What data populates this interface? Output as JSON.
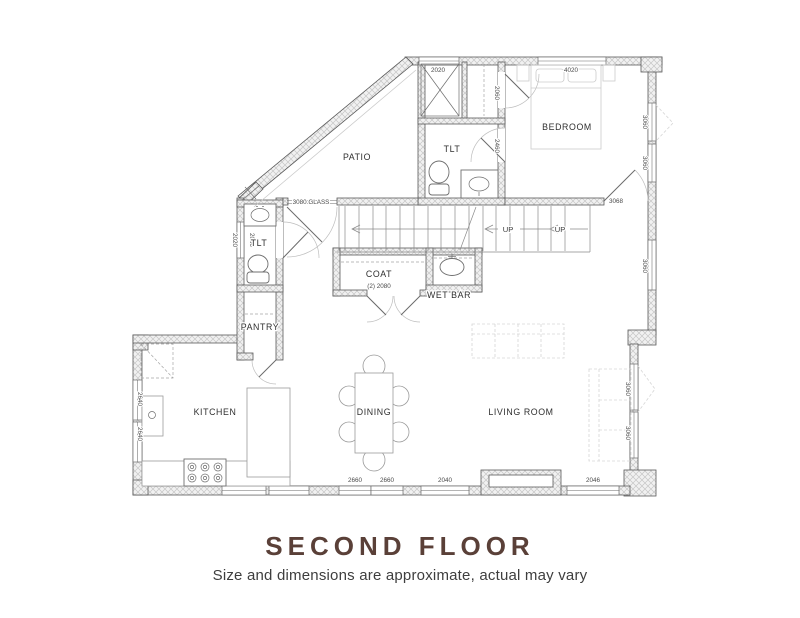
{
  "title": "SECOND FLOOR",
  "subtitle": "Size and dimensions are approximate, actual may vary",
  "colors": {
    "title_accent": "#5a4038",
    "wall_line": "#5a5a5a",
    "hatch": "#c6c6c6"
  },
  "rooms": {
    "patio": "PATIO",
    "bath_upper": "TLT",
    "bedroom": "BEDROOM",
    "coat": "COAT",
    "wet_bar": "WET BAR",
    "bath_left": "TLT",
    "pantry": "PANTRY",
    "kitchen": "KITCHEN",
    "dining": "DINING",
    "living_room": "LIVING ROOM"
  },
  "stairs": {
    "up1": "UP",
    "up2": "UP"
  },
  "dimensions": {
    "top_window_closet": "2020",
    "top_window_bedroom": "4020",
    "bedroom_window_right_1": "3060",
    "bedroom_window_right_2": "3060",
    "bedroom_door": "3068",
    "hall_window_right": "3060",
    "living_window_right_1": "3060",
    "living_window_right_2": "3060",
    "bottom_window_1": "2660",
    "bottom_window_2": "2660",
    "bottom_window_3": "2040",
    "bottom_window_4": "2046",
    "kitchen_window_left_1": "2640",
    "kitchen_window_left_2": "2640",
    "bath_left_window": "2020",
    "bath_left_door": "2060",
    "patio_glass_door": "3080 GLASS",
    "closet_door": "2060",
    "bath_upper_door": "2460",
    "coat_doors": "(2) 2080"
  }
}
